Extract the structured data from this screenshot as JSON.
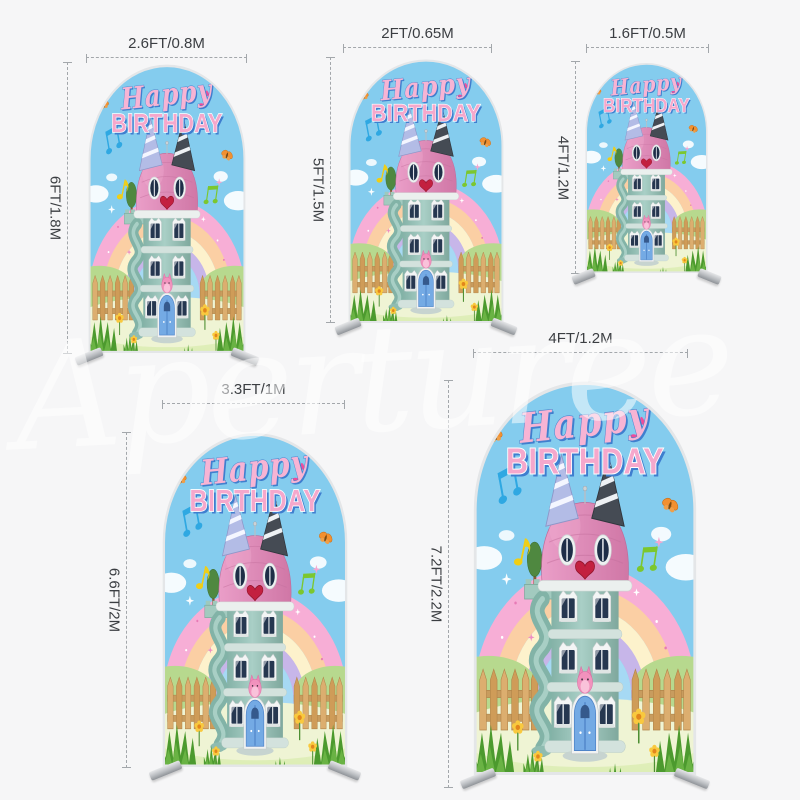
{
  "artwork": {
    "happy": "Happy",
    "birthday": "BIRTHDAY"
  },
  "watermark": {
    "text": "Aperturee"
  },
  "arches": [
    {
      "name": "arch-2.6ft",
      "width_label": "2.6FT/0.8M",
      "height_label": "6FT/1.8M"
    },
    {
      "name": "arch-2ft",
      "width_label": "2FT/0.65M",
      "height_label": "5FT/1.5M"
    },
    {
      "name": "arch-1.6ft",
      "width_label": "1.6FT/0.5M",
      "height_label": "4FT/1.2M"
    },
    {
      "name": "arch-3.3ft",
      "width_label": "3.3FT/1M",
      "height_label": "6.6FT/2M"
    },
    {
      "name": "arch-4ft",
      "width_label": "4FT/1.2M",
      "height_label": "7.2FT/2.2M"
    }
  ],
  "colors": {
    "page_bg": "#f6f6f7",
    "dimension_line": "#a3a7ab",
    "label_text": "#3b3e42",
    "sky_blue": "#84ccee",
    "rainbow": [
      "#f7aed6",
      "#fbcfa4",
      "#fdf2cc",
      "#c7b6e9",
      "#a6d9f4"
    ],
    "roof_pink": "#d886b2",
    "tower_teal": "#9ac6bc",
    "door_blue": "#74aae4",
    "fence_tan": "#dcae6f",
    "grass_green": "#4c9a2e",
    "title_pink": "#f5a8cc",
    "title_blue": "#3f7ecf",
    "heart_red": "#c32040",
    "watermark_white": "#ffffff"
  }
}
